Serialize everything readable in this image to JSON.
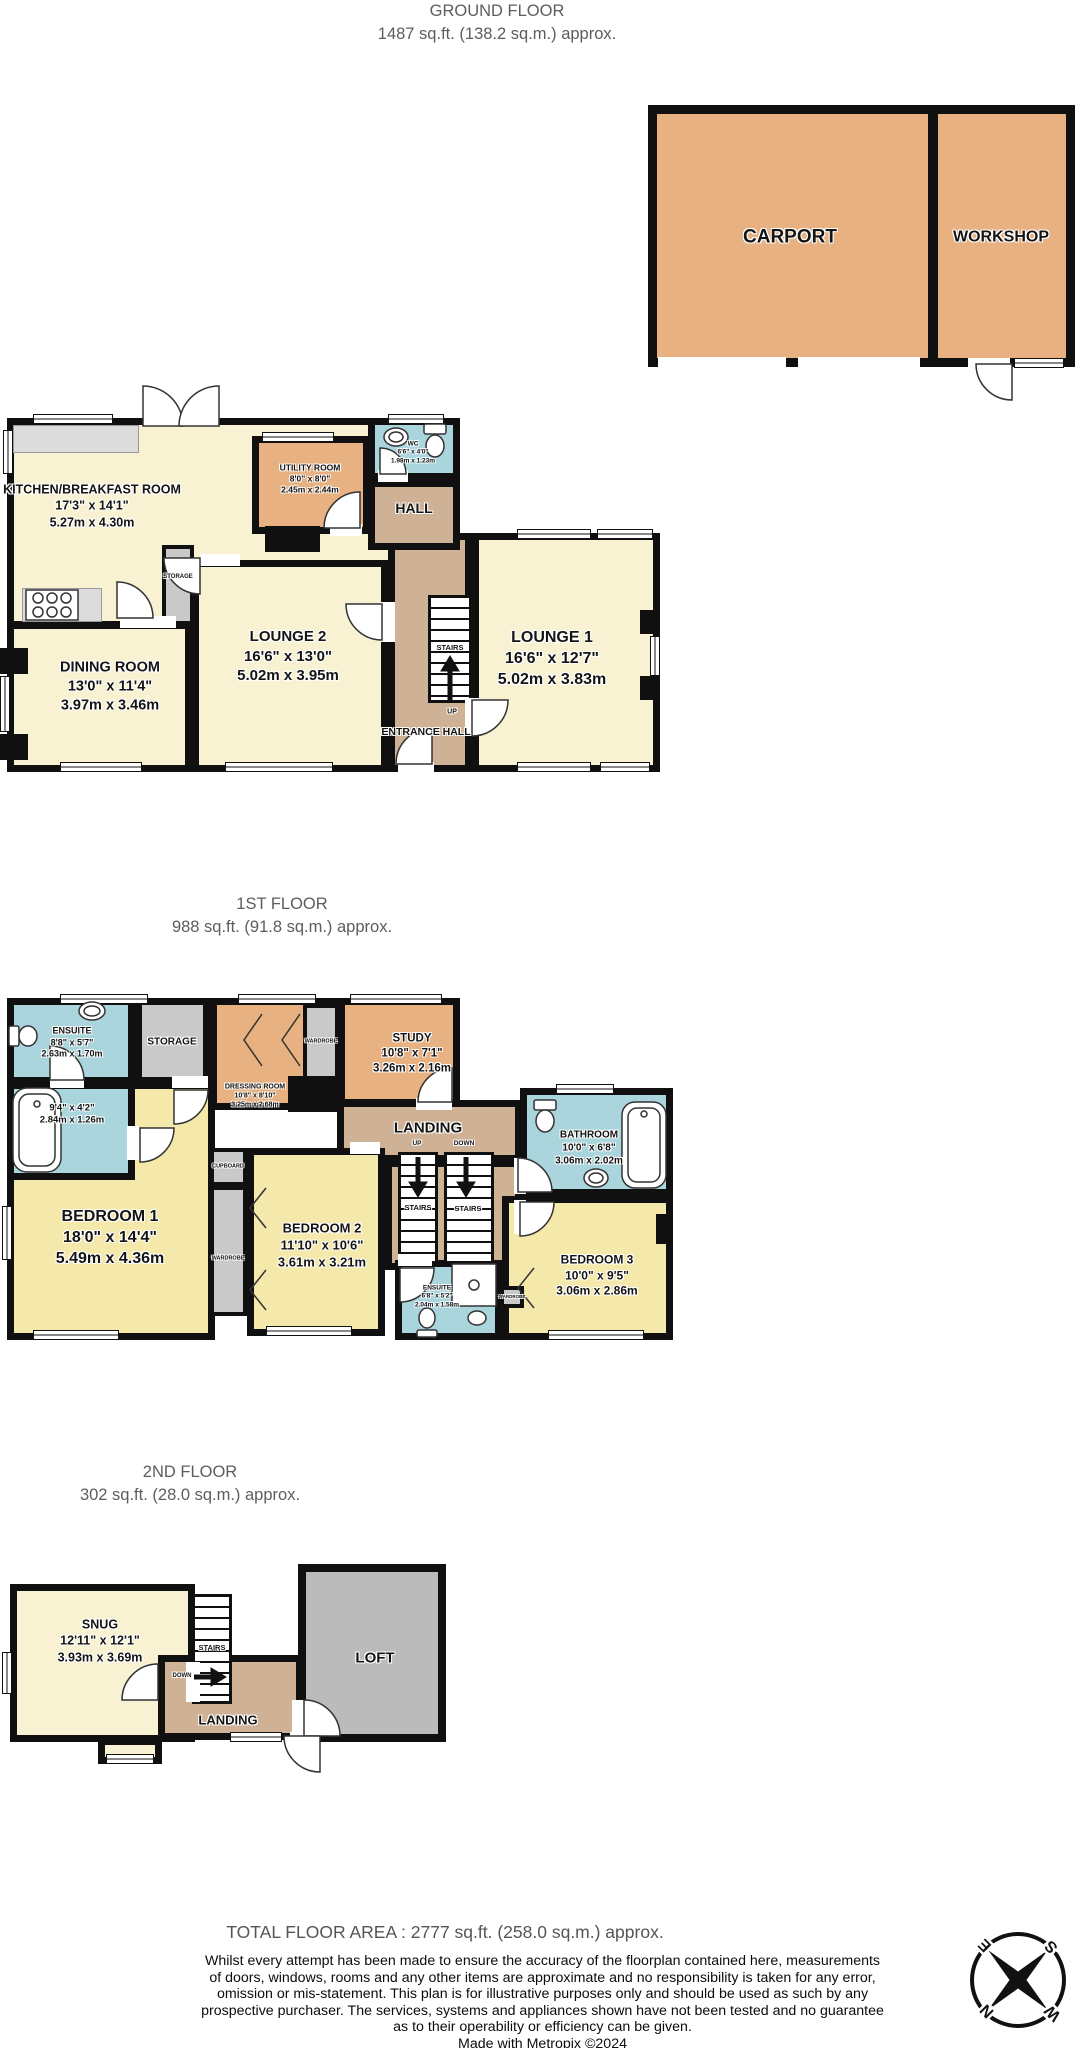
{
  "titles": {
    "ground": {
      "line1": "GROUND FLOOR",
      "line2": "1487 sq.ft. (138.2 sq.m.) approx."
    },
    "first": {
      "line1": "1ST FLOOR",
      "line2": "988 sq.ft. (91.8 sq.m.) approx."
    },
    "second": {
      "line1": "2ND FLOOR",
      "line2": "302 sq.ft. (28.0 sq.m.) approx."
    },
    "total": "TOTAL FLOOR AREA : 2777 sq.ft. (258.0 sq.m.) approx."
  },
  "outbuilding": {
    "carport": {
      "name": "CARPORT"
    },
    "workshop": {
      "name": "WORKSHOP"
    }
  },
  "ground": {
    "kitchen": {
      "name": "KITCHEN/BREAKFAST ROOM",
      "imperial": "17'3\" x 14'1\"",
      "metric": "5.27m x 4.30m"
    },
    "utility": {
      "name": "UTILITY ROOM",
      "imperial": "8'0\" x 8'0\"",
      "metric": "2.45m x 2.44m"
    },
    "wc": {
      "name": "WC",
      "imperial": "6'6\" x 4'0\"",
      "metric": "1.98m x 1.23m"
    },
    "hall": {
      "name": "HALL"
    },
    "storage": {
      "name": "STORAGE"
    },
    "dining": {
      "name": "DINING ROOM",
      "imperial": "13'0\" x 11'4\"",
      "metric": "3.97m x 3.46m"
    },
    "lounge2": {
      "name": "LOUNGE 2",
      "imperial": "16'6\" x 13'0\"",
      "metric": "5.02m x 3.95m"
    },
    "lounge1": {
      "name": "LOUNGE 1",
      "imperial": "16'6\" x 12'7\"",
      "metric": "5.02m x 3.83m"
    },
    "entrance": {
      "name": "ENTRANCE HALL"
    },
    "stairs": {
      "label": "STAIRS",
      "up": "UP"
    }
  },
  "first": {
    "ensuite1": {
      "name": "ENSUITE",
      "imperial": "8'8\" x 5'7\"",
      "metric": "2.63m x 1.70m"
    },
    "bath2": {
      "imperial": "9'4\" x 4'2\"",
      "metric": "2.84m x 1.26m"
    },
    "storage": {
      "name": "STORAGE"
    },
    "dressing": {
      "name": "DRESSING ROOM",
      "imperial": "10'8\" x 8'10\"",
      "metric": "3.25m x 2.68m"
    },
    "study": {
      "name": "STUDY",
      "imperial": "10'8\" x 7'1\"",
      "metric": "3.26m x 2.16m"
    },
    "landing": {
      "name": "LANDING",
      "up": "UP",
      "down": "DOWN"
    },
    "bathroom": {
      "name": "BATHROOM",
      "imperial": "10'0\" x 6'8\"",
      "metric": "3.06m x 2.02m"
    },
    "bedroom1": {
      "name": "BEDROOM 1",
      "imperial": "18'0\" x 14'4\"",
      "metric": "5.49m x 4.36m"
    },
    "bedroom2": {
      "name": "BEDROOM 2",
      "imperial": "11'10\" x 10'6\"",
      "metric": "3.61m x 3.21m"
    },
    "bedroom3": {
      "name": "BEDROOM 3",
      "imperial": "10'0\" x 9'5\"",
      "metric": "3.06m x 2.86m"
    },
    "ensuite2": {
      "name": "ENSUITE",
      "imperial": "6'8\" x 5'2\"",
      "metric": "2.04m x 1.58m"
    },
    "cupboard": {
      "name": "CUPBOARD"
    },
    "wardrobe": {
      "name": "WARDROBE"
    },
    "stairs": {
      "label": "STAIRS"
    }
  },
  "second": {
    "snug": {
      "name": "SNUG",
      "imperial": "12'11\" x 12'1\"",
      "metric": "3.93m x 3.69m"
    },
    "loft": {
      "name": "LOFT"
    },
    "landing": {
      "name": "LANDING"
    },
    "stairs": {
      "label": "STAIRS",
      "down": "DOWN"
    }
  },
  "disclaimer": {
    "line1": "Whilst every attempt has been made to ensure the accuracy of the floorplan contained here, measurements",
    "line2": "of doors, windows, rooms and any other items are approximate and no responsibility is taken for any error,",
    "line3": "omission or mis-statement. This plan is for illustrative purposes only and should be used as such by any",
    "line4": "prospective purchaser. The services, systems and appliances shown have not been tested and no guarantee",
    "line5": "as to their operability or efficiency can be given.",
    "line6": "Made with Metropix ©2024"
  },
  "compass": {
    "n": "N",
    "s": "S",
    "e": "E",
    "w": "W"
  },
  "colors": {
    "outbuilding_tan": "#e7b181",
    "room_cream": "#f8f2d3",
    "room_yellow": "#f5e8ab",
    "room_blue": "#abd5dc",
    "room_gray": "#c9c9c9",
    "hall_tan": "#cfb295",
    "loft_gray": "#bbbbbb",
    "wall": "#101010",
    "title_gray": "#5d5d5d"
  }
}
